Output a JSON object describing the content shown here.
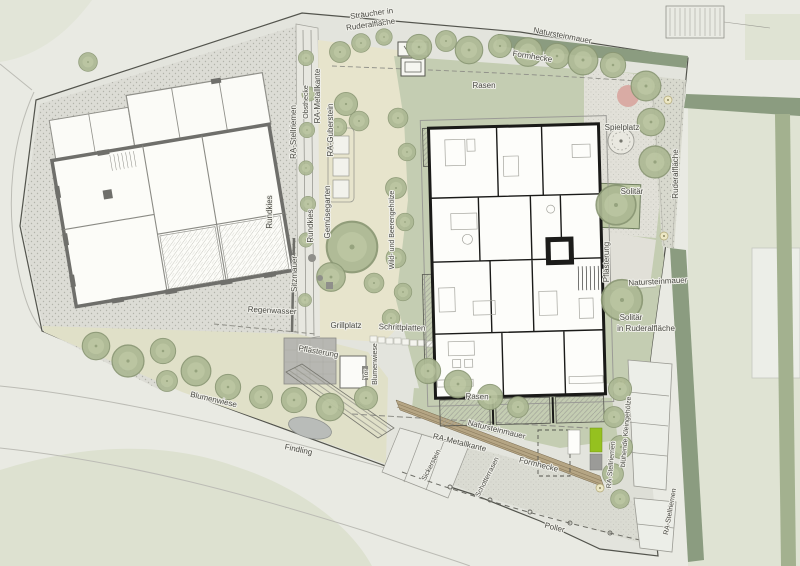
{
  "plan": {
    "type": "landscape-site-plan",
    "language": "de"
  },
  "labels": {
    "straeucher_1": "Sträucher in",
    "straeucher_2": "Ruderalfläche",
    "natursteinmauer_top": "Natursteinmauer",
    "formhecke_top": "Formhecke",
    "rasen_top": "Rasen",
    "ra_stellriemen_left": "RA-Stellriemen",
    "obsthecke": "Obsthecke",
    "ra_metallkante_left": "RA-Metallkante",
    "ra_guberstein": "RA-Guberstein",
    "gemuesegarten": "Gemüsegarten",
    "rundkies_1": "Rundkies",
    "rundkies_2": "Rundkies",
    "sitzmauer": "Sitzmauer",
    "wild_beeren": "Wild- und Beerengehölze",
    "regenwasser": "Regenwasser",
    "grillplatz": "Grillplatz",
    "pflaesterung_mid": "Pflästerung",
    "schrittplatten": "Schrittplatten",
    "blumenwiese_v": "Blumenwiese",
    "tor": "Tor",
    "blumenwiese_d": "Blumenwiese",
    "findling": "Findling",
    "spielplatz": "Spielplatz",
    "solitaer": "Solitär",
    "ruderalflaeche_r": "Ruderalfläche",
    "pflaesterung_r": "Pflästerung",
    "natursteinmauer_r": "Natursteinmauer",
    "solitaer_ruderal_1": "Solitär",
    "solitaer_ruderal_2": "in Ruderalfläche",
    "rasen_bottom": "Rasen",
    "natursteinmauer_b": "Natursteinmauer",
    "ra_metallkante_b": "RA-Metallkante",
    "sickerstein": "Sickerstein",
    "schotterrasen": "Schotterrasen",
    "formhecke_b": "Formhecke",
    "poller": "Poller",
    "ra_stellriemen_b1": "RA-Stellriemen",
    "bluehende": "blühende Kleingehölze",
    "ra_stellriemen_b2": "RA-Stellriemen"
  },
  "colors": {
    "paper": "#e9eae3",
    "parcel": "#e3e4dd",
    "lawn": "#c4cdb2",
    "meadow": "#e0e0c8",
    "garden_beige": "#e7e4cc",
    "hedge_dark_green": "#8b9c80",
    "tree_green": "#acb893",
    "playground_pink": "#d9aba4",
    "bin_bright_green": "#95c11f",
    "wall_brown": "#b5a584",
    "building_new_wall": "#1a1a18",
    "building_old_wall": "#6f6f6b"
  }
}
